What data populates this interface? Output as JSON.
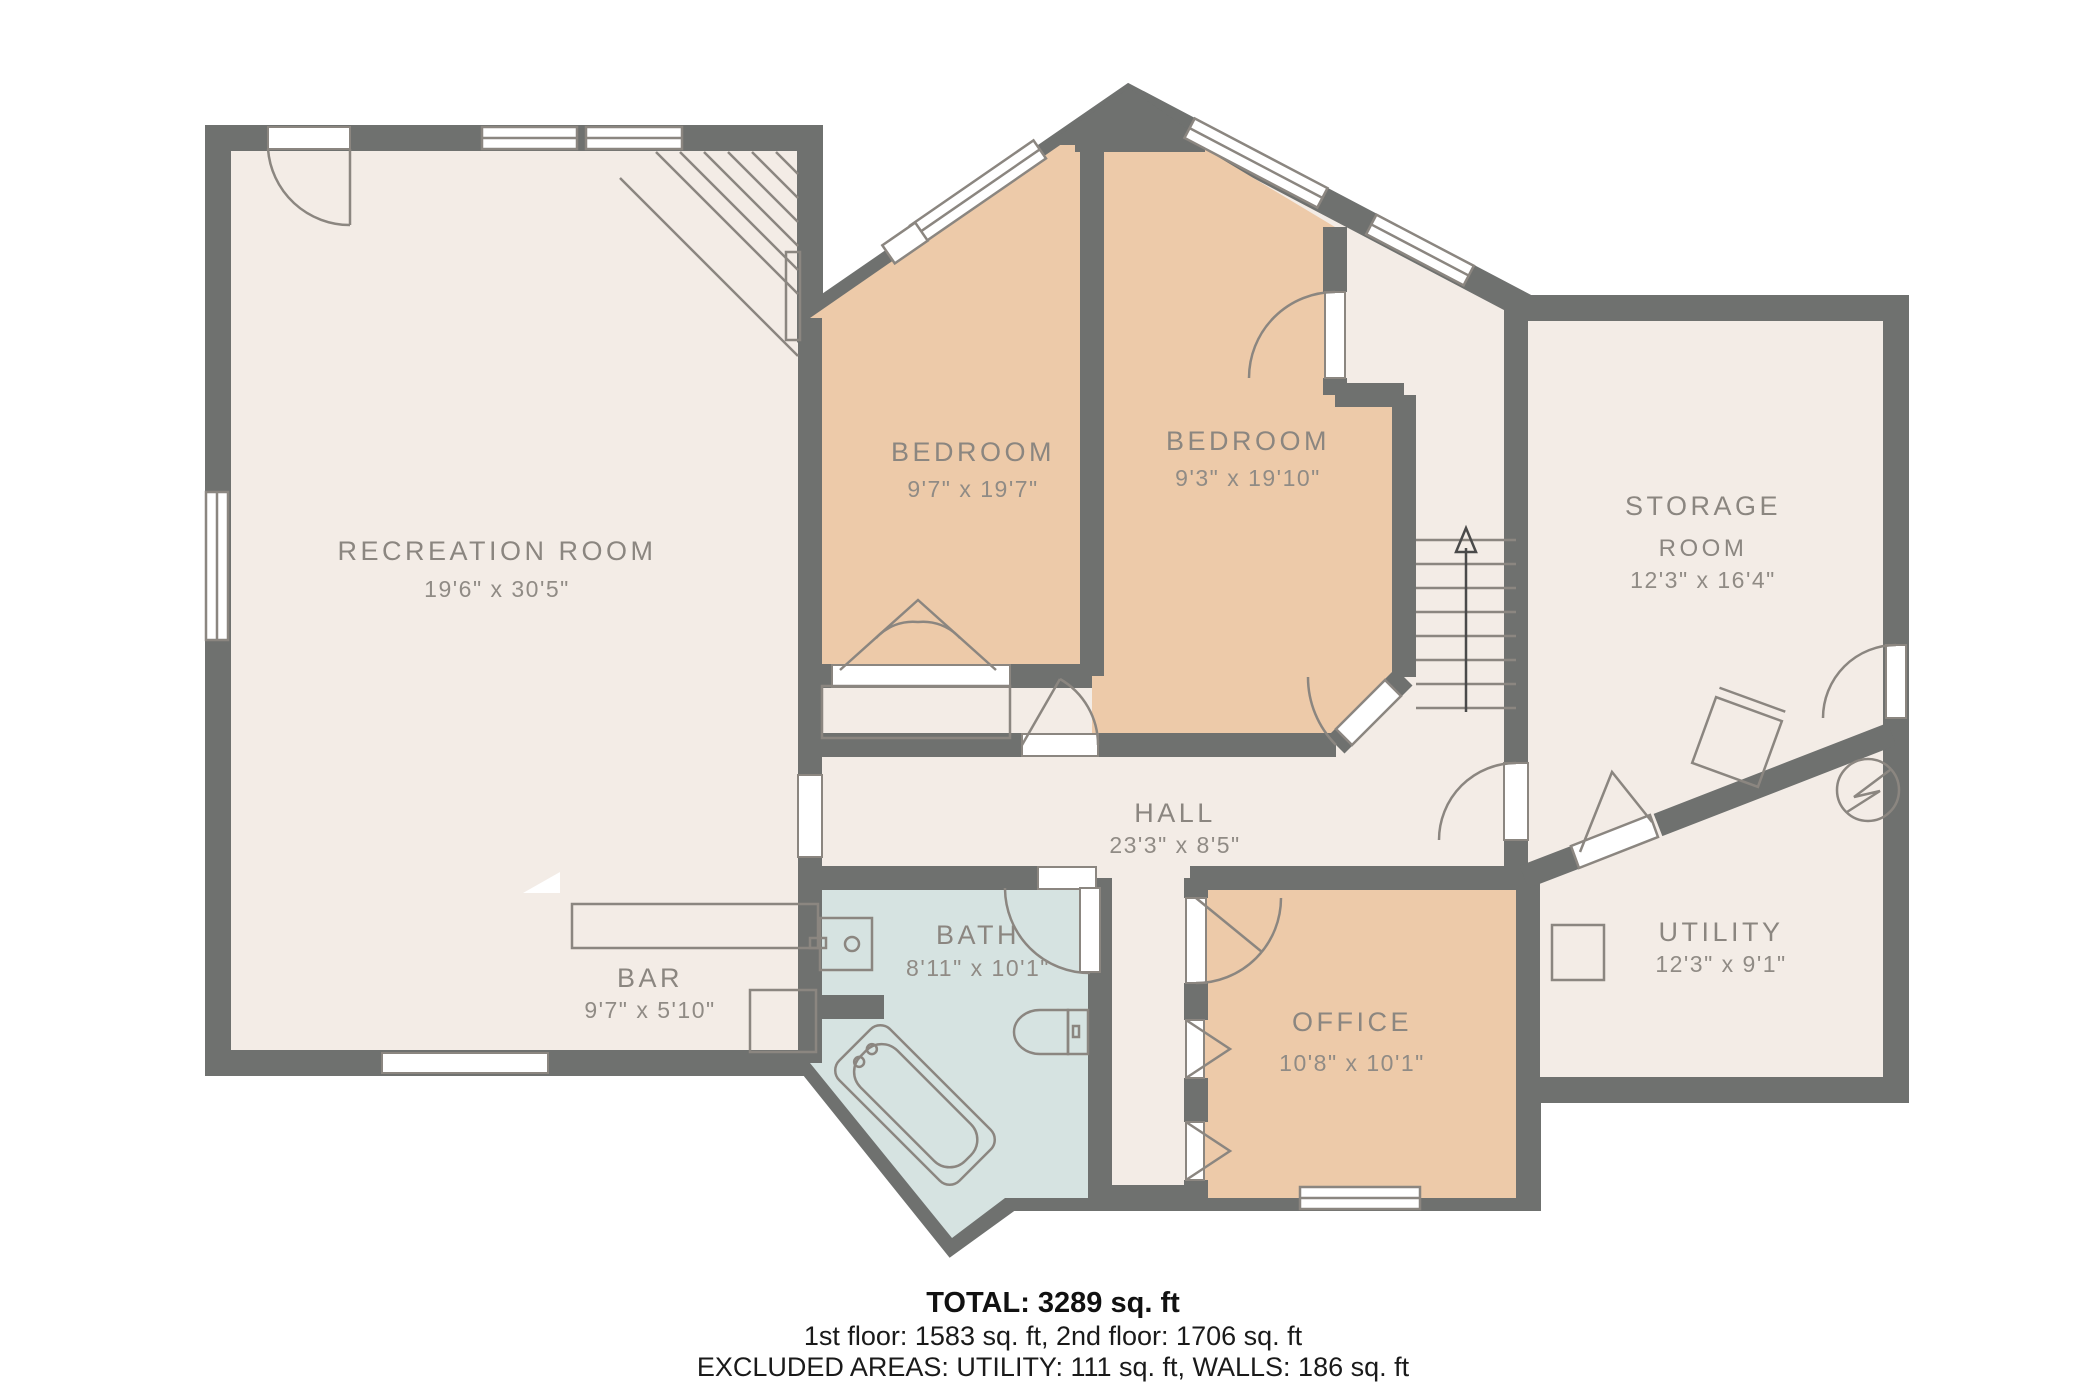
{
  "rooms": {
    "recreation": {
      "name": "RECREATION ROOM",
      "dims": "19'6\" x 30'5\""
    },
    "bedroom_left": {
      "name": "BEDROOM",
      "dims": "9'7\" x 19'7\""
    },
    "bedroom_right": {
      "name": "BEDROOM",
      "dims": "9'3\" x 19'10\""
    },
    "storage": {
      "name": "STORAGE",
      "name2": "ROOM",
      "dims": "12'3\" x 16'4\""
    },
    "hall": {
      "name": "HALL",
      "dims": "23'3\" x 8'5\""
    },
    "bath": {
      "name": "BATH",
      "dims": "8'11\" x 10'1\""
    },
    "bar": {
      "name": "BAR",
      "dims": "9'7\" x 5'10\""
    },
    "office": {
      "name": "OFFICE",
      "dims": "10'8\" x 10'1\""
    },
    "utility": {
      "name": "UTILITY",
      "dims": "12'3\" x 9'1\""
    }
  },
  "footer": {
    "total": "TOTAL: 3289 sq. ft",
    "floors": "1st floor: 1583 sq. ft, 2nd floor: 1706 sq. ft",
    "excluded": "EXCLUDED AREAS: UTILITY: 111 sq. ft, WALLS: 186 sq. ft"
  },
  "colors": {
    "wall": "#6f716f",
    "room_beige": "#f3ece6",
    "room_peach": "#edcaa9",
    "room_blue": "#d6e3e1",
    "label_gray": "#8b8680"
  }
}
